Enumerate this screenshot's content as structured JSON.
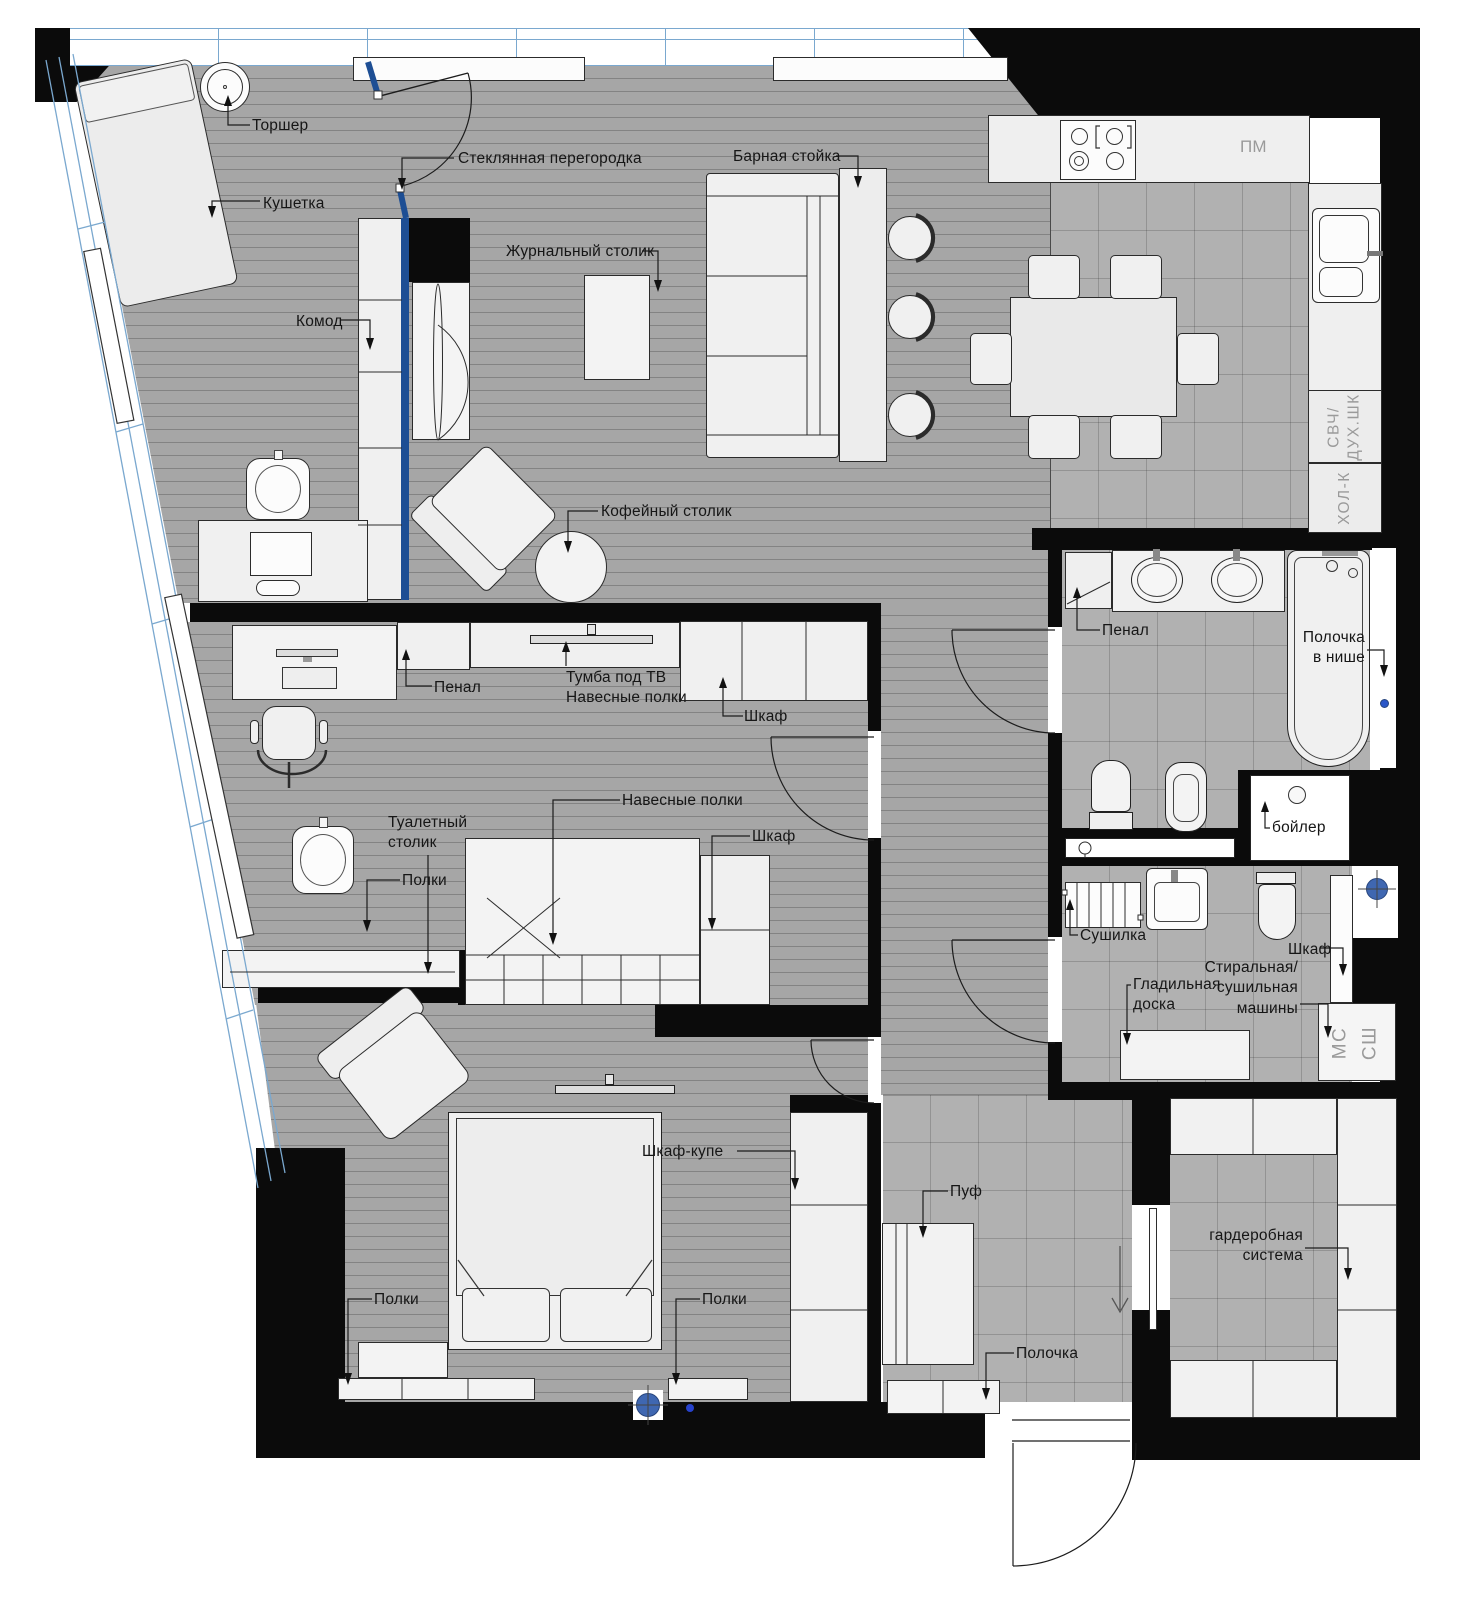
{
  "title": "Apartment furniture floor plan",
  "colors": {
    "wall": "#0b0b0b",
    "floor_plank": "#a6a6a6",
    "floor_tile": "#b1b1b1",
    "furniture": "#f0f0f0",
    "glass_frame": "#7aa8cf",
    "glass_partition": "#1d4e94",
    "marker_blue": "#3f67b1",
    "label": "#161616",
    "muted_label": "#9a9a9a"
  },
  "annotations": [
    {
      "name": "label-torsher",
      "text": "Торшер",
      "x": 252,
      "y": 116
    },
    {
      "name": "label-kushetka",
      "text": "Кушетка",
      "x": 263,
      "y": 194
    },
    {
      "name": "label-glass-partition",
      "text": "Стеклянная перегородка",
      "x": 458,
      "y": 149
    },
    {
      "name": "label-journal-table",
      "text": "Журнальный столик",
      "x": 506,
      "y": 242
    },
    {
      "name": "label-bar-counter",
      "text": "Барная стойка",
      "x": 733,
      "y": 147
    },
    {
      "name": "label-pm",
      "text": "ПМ",
      "x": 1240,
      "y": 136,
      "size": 17,
      "muted": true
    },
    {
      "name": "label-svch-duh",
      "text": "СВЧ/\nДУХ.ШК",
      "x": 1345,
      "y": 427,
      "mode": "c-rot",
      "muted": true
    },
    {
      "name": "label-hol-k",
      "text": "ХОЛ-К",
      "x": 1345,
      "y": 498,
      "mode": "c-rot",
      "muted": true
    },
    {
      "name": "label-komod",
      "text": "Комод",
      "x": 296,
      "y": 312
    },
    {
      "name": "label-coffee-table",
      "text": "Кофейный столик",
      "x": 601,
      "y": 502
    },
    {
      "name": "label-penal-office",
      "text": "Пенал",
      "x": 434,
      "y": 678
    },
    {
      "name": "label-tv-stand",
      "text": "Тумба под ТВ\nНавесные полки",
      "x": 566,
      "y": 668
    },
    {
      "name": "label-shkaf-office",
      "text": "Шкаф",
      "x": 744,
      "y": 707
    },
    {
      "name": "label-navesnye-polki",
      "text": "Навесные полки",
      "x": 622,
      "y": 791
    },
    {
      "name": "label-shkaf-office-2",
      "text": "Шкаф",
      "x": 752,
      "y": 827
    },
    {
      "name": "label-tualetny-stolik",
      "text": "Туалетный\nстолик",
      "x": 388,
      "y": 813
    },
    {
      "name": "label-polki-office",
      "text": "Полки",
      "x": 402,
      "y": 871
    },
    {
      "name": "label-penal-bath",
      "text": "Пенал",
      "x": 1102,
      "y": 621
    },
    {
      "name": "label-polochka-v-nishe",
      "text": "Полочка\nв нише",
      "x": 1365,
      "y": 628,
      "mode": "tr"
    },
    {
      "name": "label-boiler",
      "text": "бойлер",
      "x": 1272,
      "y": 818
    },
    {
      "name": "label-sushilka",
      "text": "Сушилка",
      "x": 1080,
      "y": 926
    },
    {
      "name": "label-shkaf-laundry",
      "text": "Шкаф",
      "x": 1288,
      "y": 940
    },
    {
      "name": "label-gladilnaya-doska",
      "text": "Гладильная\nдоска",
      "x": 1133,
      "y": 975
    },
    {
      "name": "label-washer-dryer",
      "text": "Стиральная/\nсушильная\nмашины",
      "x": 1298,
      "y": 958,
      "mode": "tr"
    },
    {
      "name": "label-ms",
      "text": "МС",
      "x": 1340,
      "y": 1043,
      "mode": "c-rot",
      "size": 19,
      "muted": true
    },
    {
      "name": "label-ssh",
      "text": "СШ",
      "x": 1370,
      "y": 1043,
      "mode": "c-rot",
      "size": 19,
      "muted": true
    },
    {
      "name": "label-shkaf-kupe",
      "text": "Шкаф-купе",
      "x": 642,
      "y": 1142
    },
    {
      "name": "label-polki-bed-left",
      "text": "Полки",
      "x": 374,
      "y": 1290
    },
    {
      "name": "label-polki-bed-right",
      "text": "Полки",
      "x": 702,
      "y": 1290
    },
    {
      "name": "label-puf",
      "text": "Пуф",
      "x": 950,
      "y": 1182
    },
    {
      "name": "label-polochka-hall",
      "text": "Полочка",
      "x": 1016,
      "y": 1344
    },
    {
      "name": "label-garderob",
      "text": "гардеробная\nсистема",
      "x": 1303,
      "y": 1226,
      "mode": "tr"
    }
  ]
}
